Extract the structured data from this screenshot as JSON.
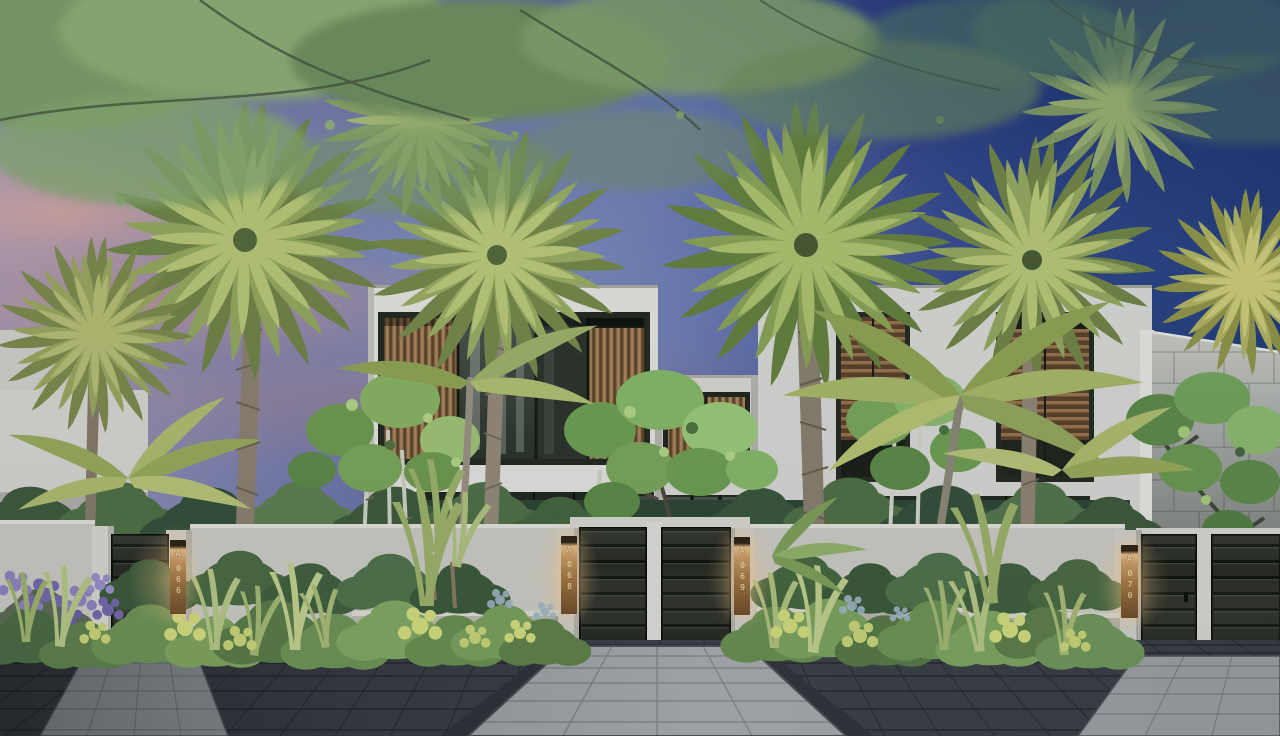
{
  "scene": {
    "description": "Dusk architectural rendering: modern white two-storey villas with timber louvre screens behind fan palms and lush tropical planting, dark entry gates with bronze unit-number plates, charcoal paver court with light stone walkways",
    "time_of_day": "dusk",
    "palette": {
      "sky_deep_blue": "#1d3674",
      "sky_mid_blue": "#48599c",
      "sky_mauve": "#8588b1",
      "sky_pink_streak": "#e0a48c",
      "villa_wall": "#e3e3de",
      "timber_louvre": "#a8845a",
      "gate_panel": "#272b21",
      "stone_wall_tile": "#c7c9c3",
      "dark_paver": "#3d4248",
      "light_paver": "#a8adaf",
      "palm_green": "#9db25e",
      "plate_bronze": "#a87c46",
      "plate_text": "#f3e3b2"
    }
  },
  "gates": [
    {
      "id": "gate-1",
      "letter": "A",
      "number": "066"
    },
    {
      "id": "gate-2",
      "letter": "A",
      "number": "068"
    },
    {
      "id": "gate-3",
      "letter": "A",
      "number": "069"
    },
    {
      "id": "gate-4",
      "letter": "A",
      "number": "070"
    }
  ]
}
